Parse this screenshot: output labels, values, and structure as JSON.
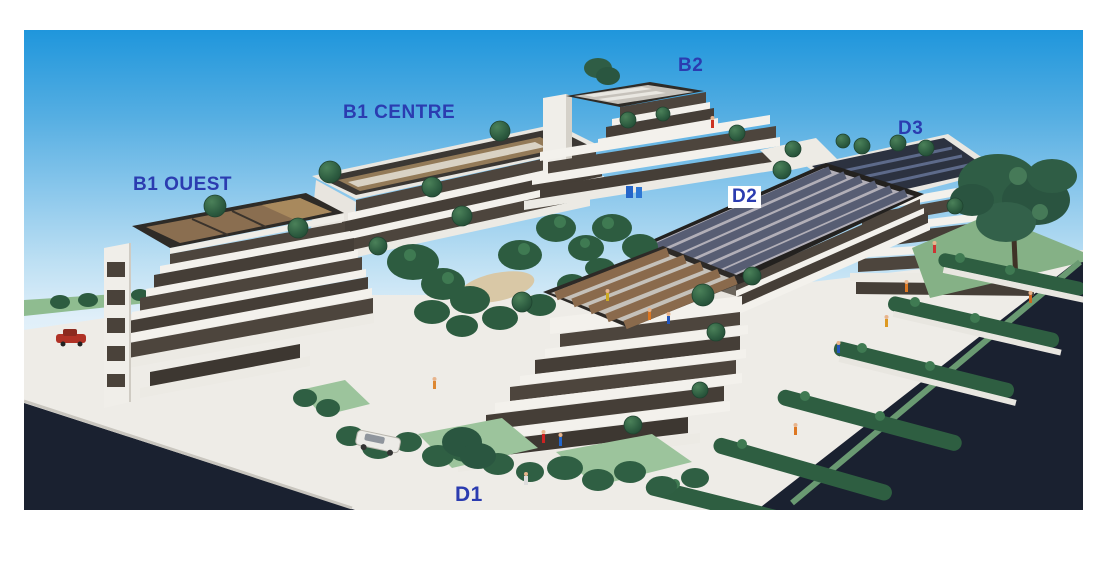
{
  "photo": {
    "kind": "architectural-model-photo",
    "colors": {
      "label_blue": "#2b3cb0",
      "d2_label_background": "#ffffff",
      "sky_top": "#1f96dc",
      "sky_bottom": "#f1f7fb",
      "road_dark": "#1a2130",
      "lawn_green": "#8fbc90",
      "hedge_green": "#2e5e41",
      "building_white": "#f3f1ec",
      "window_band": "#4d453d",
      "roof_panel_brown": "#8a6e50",
      "roof_panel_slate": "#575d73",
      "solar_panel_dark": "#2c3240"
    }
  },
  "labels": {
    "b1_ouest": {
      "text": "B1 OUEST"
    },
    "b1_centre": {
      "text": "B1 CENTRE"
    },
    "b2": {
      "text": "B2"
    },
    "d2": {
      "text": "D2"
    },
    "d3": {
      "text": "D3"
    },
    "d1": {
      "text": "D1"
    }
  }
}
